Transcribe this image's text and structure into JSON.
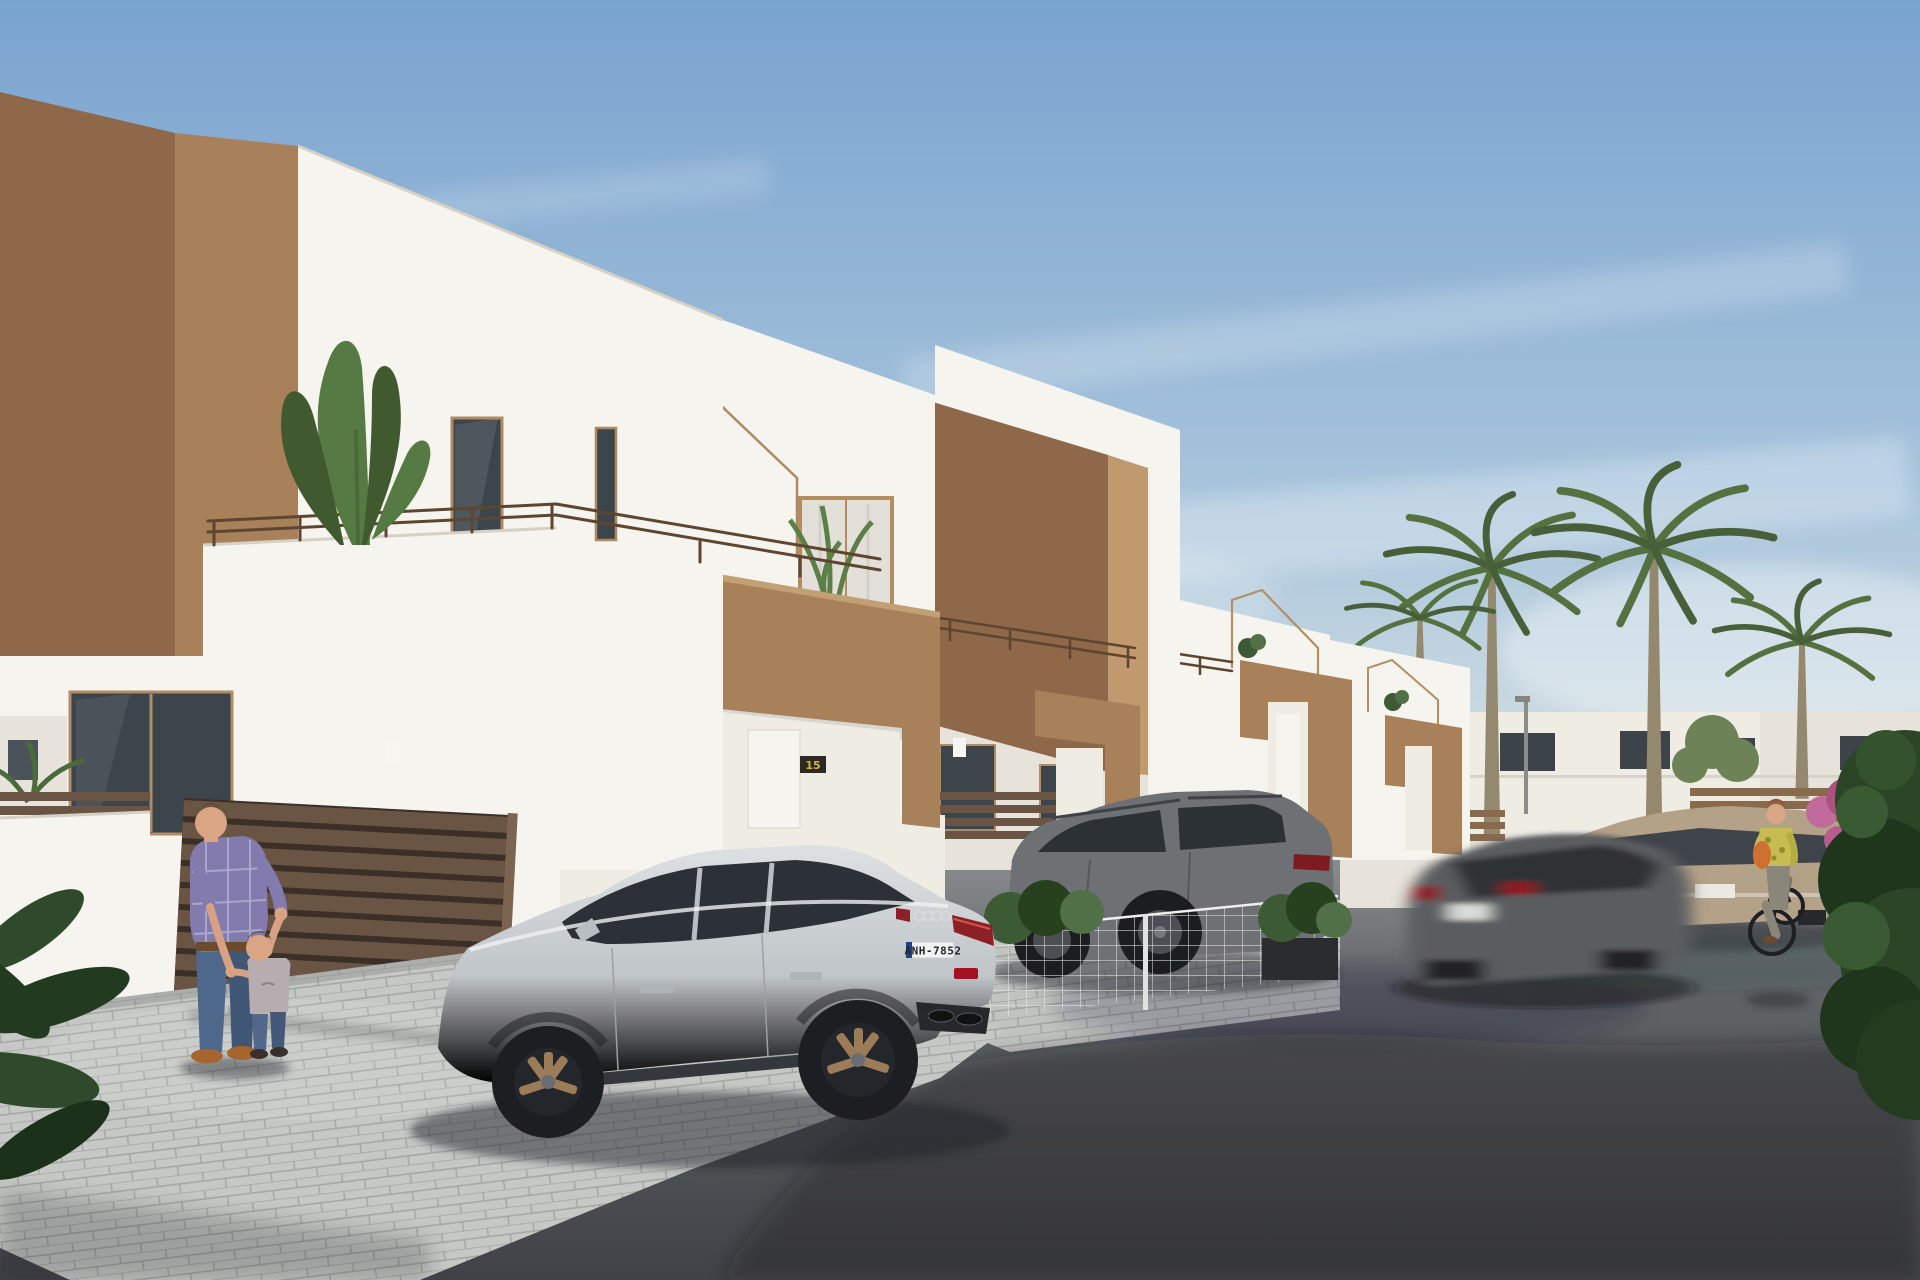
{
  "scene": {
    "kind": "architectural-exterior-render",
    "description": "Sunny street of new-build two-storey townhouses, white stucco with terracotta-brown accent volumes, flat roofs, balconies with thin metal railings and plants. A silver sportback is parked on a paver driveway, a grey SUV behind a white mesh fence, a motion-blurred dark hatchback drives past a parked beige crossover. A man plays with a toddler by a brown slatted gate, a woman cycles on the right. Palm trees and white buildings in the background.",
    "houses_visible": 4,
    "vehicles": [
      "silver-sportback-parked",
      "grey-suv-parked",
      "dark-hatchback-driving-blurred",
      "beige-crossover-parked"
    ],
    "people": [
      "man-with-toddler",
      "female-cyclist"
    ]
  },
  "texts": {
    "license_plate": "ANH-7852",
    "house_number_left": "14",
    "house_number_right": "15"
  },
  "palette": {
    "sky_top": "#79a3cf",
    "sky_horizon": "#e2e8e6",
    "wall_white": "#f6f4ee",
    "accent_brown": "#a8805a",
    "accent_brown_dark": "#8f684a",
    "accent_brown_light": "#c09a6e",
    "asphalt": "#55595d",
    "paver": "#c6c8c5",
    "palm_green": "#55713f",
    "audi_silver": "#c7cbce",
    "suv_grey": "#6e7174",
    "beige_car": "#b4a288",
    "shirt_purple": "#837aae",
    "jeans_blue": "#4e688c",
    "cyclist_top": "#c5bd52",
    "bag_orange": "#d07030",
    "taillight_red": "#8c2026",
    "plaque_gold": "#d9b23c"
  }
}
